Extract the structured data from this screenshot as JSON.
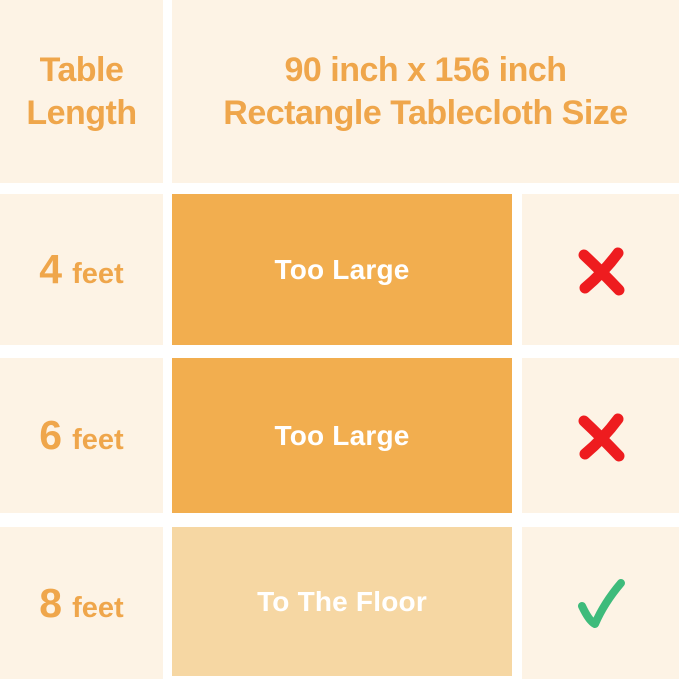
{
  "colors": {
    "background": "#FFFFFF",
    "cell_cream": "#FDF3E5",
    "box_orange": "#F2AE4F",
    "box_light_orange": "#F6D7A3",
    "text_orange": "#EFA64B",
    "text_white": "#FFFFFF",
    "cross_red": "#EE1C1F",
    "check_green": "#3EBB7B"
  },
  "header": {
    "row_label": {
      "line1": "Table",
      "line2": "Length"
    },
    "size_title": {
      "line1": "90 inch x 156 inch",
      "line2": "Rectangle Tablecloth Size"
    }
  },
  "rows": [
    {
      "length_value": "4",
      "length_unit": "feet",
      "fit_label": "Too Large",
      "verdict_icon": "cross-icon"
    },
    {
      "length_value": "6",
      "length_unit": "feet",
      "fit_label": "Too Large",
      "verdict_icon": "cross-icon"
    },
    {
      "length_value": "8",
      "length_unit": "feet",
      "fit_label": "To The Floor",
      "verdict_icon": "check-icon"
    }
  ],
  "chart_data": {
    "type": "table",
    "title": "90 inch x 156 inch Rectangle Tablecloth Size",
    "columns": [
      "Table Length",
      "Fit Result",
      "Suitable"
    ],
    "rows": [
      [
        "4 feet",
        "Too Large",
        "no"
      ],
      [
        "6 feet",
        "Too Large",
        "no"
      ],
      [
        "8 feet",
        "To The Floor",
        "yes"
      ]
    ]
  }
}
